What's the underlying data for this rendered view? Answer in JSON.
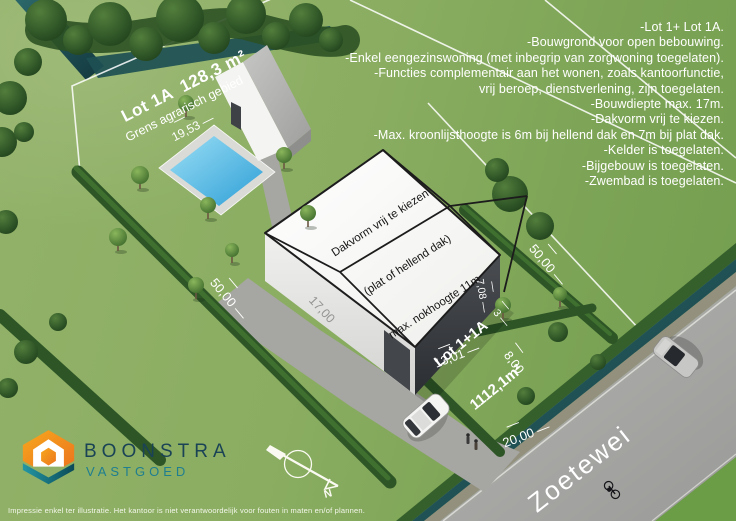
{
  "notes": {
    "lines": [
      "-Lot 1+ Lot 1A.",
      "-Bouwgrond voor open bebouwing.",
      "-Enkel eengezinswoning (met inbegrip van zorgwoning toegelaten).",
      "-Functies complementair aan het wonen, zoals kantoorfunctie,",
      "vrij beroep, dienstverlening, zijn toegelaten.",
      "-Bouwdiepte max. 17m.",
      "-Dakvorm vrij te kiezen.",
      "-Max. kroonlijsthoogte is 6m bij hellend dak en 7m bij plat dak.",
      "-Kelder is toegelaten.",
      "-Bijgebouw is toegelaten.",
      "-Zwembad is toegelaten."
    ]
  },
  "site": {
    "lot1a_label": "Lot 1A  128,3 m²",
    "boundary_label": "Grens agrarisch gebied",
    "dim_rear": "19,53",
    "dim_left_depth": "50,00",
    "dim_right_depth": "50,00",
    "dim_building_depth": "17,00",
    "dim_facade_width": "13,01",
    "dim_front_setback": "8,00",
    "dim_side_gap": "3",
    "dim_side_wall": "7,08",
    "dim_frontage": "20,00",
    "lot_combined_name": "Lot 1+1A",
    "lot_combined_area": "1112,1m²",
    "road_name": "Zoetewei"
  },
  "building_note": {
    "line1": "Dakvorm vrij te kiezen",
    "line2": "(plat of hellend dak)",
    "line3": "max. nokhoogte 11m"
  },
  "compass": {
    "north_label": "N"
  },
  "logo": {
    "company": "BOONSTRA",
    "tagline": "VASTGOED"
  },
  "disclaimer": "Impressie enkel ter illustratie. Het kantoor is niet verantwoordelijk voor fouten in maten en/of plannen.",
  "colors": {
    "grass": "#85aa5e",
    "grass_dark_field": "#6b9c46",
    "road": "#a9a9a7",
    "water": "#1f4f55",
    "pool": "#45b3e6",
    "roof_top": "#f8f8f6",
    "wall_dark": "#34373b",
    "hedge": "#33602a",
    "accent_orange": "#f29a1f",
    "accent_teal": "#1d8795",
    "logo_text_dark": "#1b4356",
    "logo_text_teal": "#1f7e90"
  }
}
